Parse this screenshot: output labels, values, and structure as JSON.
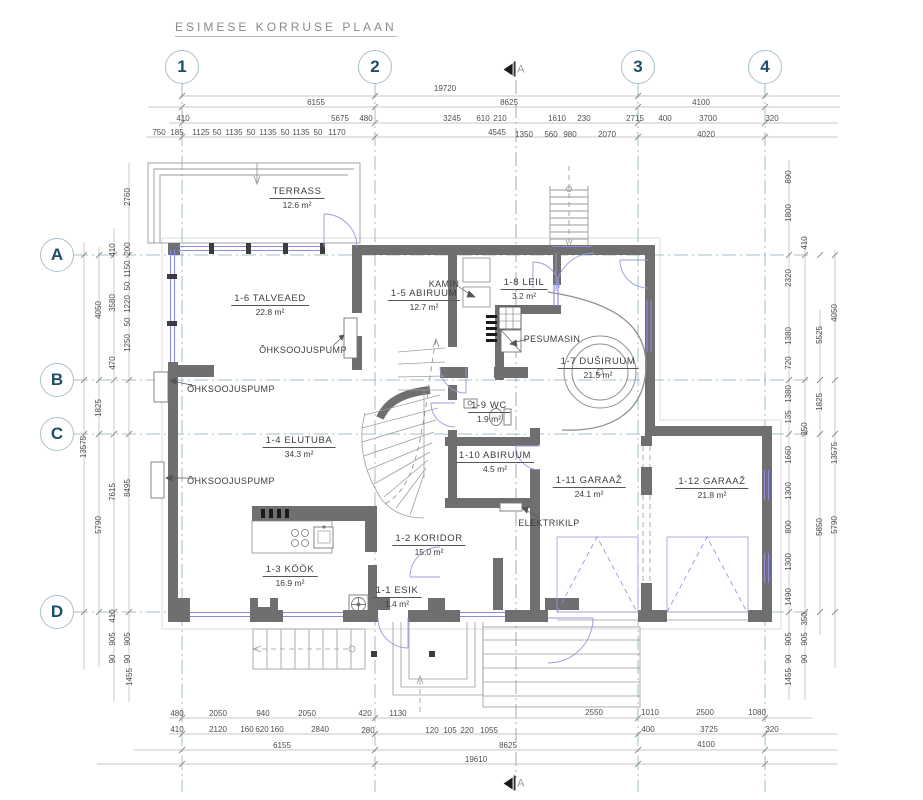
{
  "title": "ESIMESE KORRUSE PLAAN",
  "colors": {
    "wall": "#6f6f6f",
    "window_blue": "#8a8ae0",
    "grid_line": "#86aebe",
    "dim_line": "#b5b5b5",
    "bubble_text": "#1e4f68",
    "detail_line": "#999999"
  },
  "grid": {
    "columns": [
      {
        "label": "1",
        "x": 182,
        "y": 67
      },
      {
        "label": "2",
        "x": 375,
        "y": 67
      },
      {
        "label": "3",
        "x": 638,
        "y": 67
      },
      {
        "label": "4",
        "x": 765,
        "y": 67
      }
    ],
    "rows": [
      {
        "label": "A",
        "x": 57,
        "y": 255
      },
      {
        "label": "B",
        "x": 57,
        "y": 380
      },
      {
        "label": "C",
        "x": 57,
        "y": 434
      },
      {
        "label": "D",
        "x": 57,
        "y": 612
      }
    ]
  },
  "section_markers": [
    {
      "label": "A",
      "x": 514,
      "y": 69
    },
    {
      "label": "A",
      "x": 514,
      "y": 783
    }
  ],
  "rooms": [
    {
      "name": "TERRASS",
      "area": "12.6 m²",
      "x": 297,
      "y": 198
    },
    {
      "name": "1-6 TALVEAED",
      "area": "22.8 m²",
      "x": 270,
      "y": 305
    },
    {
      "name": "1-5 ABIRUUM",
      "area": "12.7 m²",
      "x": 424,
      "y": 300
    },
    {
      "name": "1-8 LEIL",
      "area": "3.2 m²",
      "x": 524,
      "y": 289
    },
    {
      "name": "1-7 DUŠIRUUM",
      "area": "21.5 m²",
      "x": 598,
      "y": 368
    },
    {
      "name": "1-9 WC",
      "area": "1.9 m²",
      "x": 489,
      "y": 412
    },
    {
      "name": "1-4 ELUTUBA",
      "area": "34.3 m²",
      "x": 299,
      "y": 447
    },
    {
      "name": "1-10 ABIRUUM",
      "area": "4.5 m²",
      "x": 495,
      "y": 462
    },
    {
      "name": "1-11 GARAAŽ",
      "area": "24.1 m²",
      "x": 589,
      "y": 487
    },
    {
      "name": "1-12 GARAAŽ",
      "area": "21.8 m²",
      "x": 712,
      "y": 488
    },
    {
      "name": "1-2 KORIDOR",
      "area": "15.0 m²",
      "x": 429,
      "y": 545
    },
    {
      "name": "1-3 KÖÖK",
      "area": "16.9 m²",
      "x": 290,
      "y": 576
    },
    {
      "name": "1-1 ESIK",
      "area": "1.4 m²",
      "x": 397,
      "y": 597
    }
  ],
  "annotations": [
    {
      "t": "ÕHKSOOJUSPUMP",
      "x": 303,
      "y": 350
    },
    {
      "t": "ÕHKSOOJUSPUMP",
      "x": 231,
      "y": 389
    },
    {
      "t": "ÕHKSOOJUSPUMP",
      "x": 231,
      "y": 481
    },
    {
      "t": "KAMIN",
      "x": 444,
      "y": 284
    },
    {
      "t": "PESUMASIN",
      "x": 552,
      "y": 339
    },
    {
      "t": "ELEKTRIKILP",
      "x": 549,
      "y": 523
    }
  ],
  "dim_labels": [
    [
      "19720",
      445,
      89,
      0
    ],
    [
      "6155",
      316,
      103,
      0
    ],
    [
      "8625",
      509,
      103,
      0
    ],
    [
      "4100",
      701,
      103,
      0
    ],
    [
      "410",
      183,
      119,
      0
    ],
    [
      "5675",
      340,
      119,
      0
    ],
    [
      "480",
      366,
      119,
      0
    ],
    [
      "3245",
      452,
      119,
      0
    ],
    [
      "610",
      483,
      119,
      0
    ],
    [
      "210",
      500,
      119,
      0
    ],
    [
      "1610",
      557,
      119,
      0
    ],
    [
      "230",
      584,
      119,
      0
    ],
    [
      "2715",
      635,
      119,
      0
    ],
    [
      "400",
      665,
      119,
      0
    ],
    [
      "3700",
      708,
      119,
      0
    ],
    [
      "320",
      772,
      119,
      0
    ],
    [
      "750",
      159,
      133,
      0
    ],
    [
      "185",
      177,
      133,
      0
    ],
    [
      "1125",
      201,
      133,
      0
    ],
    [
      "50",
      217,
      133,
      0
    ],
    [
      "1135",
      234,
      133,
      0
    ],
    [
      "50",
      251,
      133,
      0
    ],
    [
      "1135",
      268,
      133,
      0
    ],
    [
      "50",
      285,
      133,
      0
    ],
    [
      "1135",
      301,
      133,
      0
    ],
    [
      "50",
      318,
      133,
      0
    ],
    [
      "1170",
      337,
      133,
      0
    ],
    [
      "4545",
      497,
      133,
      0
    ],
    [
      "1350",
      524,
      135,
      0
    ],
    [
      "560",
      551,
      135,
      0
    ],
    [
      "980",
      570,
      135,
      0
    ],
    [
      "2070",
      607,
      135,
      0
    ],
    [
      "4020",
      706,
      135,
      0
    ],
    [
      "480",
      177,
      714,
      0
    ],
    [
      "2050",
      218,
      714,
      0
    ],
    [
      "940",
      263,
      714,
      0
    ],
    [
      "2050",
      307,
      714,
      0
    ],
    [
      "420",
      365,
      714,
      0
    ],
    [
      "1130",
      398,
      714,
      0
    ],
    [
      "2550",
      594,
      713,
      0
    ],
    [
      "1010",
      650,
      713,
      0
    ],
    [
      "2500",
      705,
      713,
      0
    ],
    [
      "1080",
      757,
      713,
      0
    ],
    [
      "410",
      177,
      730,
      0
    ],
    [
      "2120",
      218,
      730,
      0
    ],
    [
      "160",
      247,
      730,
      0
    ],
    [
      "620",
      262,
      730,
      0
    ],
    [
      "160",
      277,
      730,
      0
    ],
    [
      "2840",
      320,
      730,
      0
    ],
    [
      "280",
      368,
      731,
      0
    ],
    [
      "120",
      432,
      731,
      0
    ],
    [
      "105",
      450,
      731,
      0
    ],
    [
      "220",
      467,
      731,
      0
    ],
    [
      "1055",
      489,
      731,
      0
    ],
    [
      "400",
      648,
      730,
      0
    ],
    [
      "3725",
      709,
      730,
      0
    ],
    [
      "320",
      772,
      730,
      0
    ],
    [
      "6155",
      282,
      746,
      0
    ],
    [
      "8625",
      508,
      746,
      0
    ],
    [
      "4100",
      706,
      745,
      0
    ],
    [
      "19610",
      476,
      760,
      0
    ],
    [
      "13575",
      84,
      447,
      1
    ],
    [
      "4050",
      99,
      310,
      1
    ],
    [
      "1825",
      99,
      408,
      1
    ],
    [
      "5790",
      99,
      525,
      1
    ],
    [
      "410",
      113,
      250,
      1
    ],
    [
      "3580",
      113,
      303,
      1
    ],
    [
      "470",
      113,
      363,
      1
    ],
    [
      "7615",
      113,
      492,
      1
    ],
    [
      "410",
      113,
      616,
      1
    ],
    [
      "905",
      113,
      639,
      1
    ],
    [
      "90",
      113,
      659,
      1
    ],
    [
      "2760",
      128,
      197,
      1
    ],
    [
      "200",
      128,
      249,
      1
    ],
    [
      "1150",
      128,
      269,
      1
    ],
    [
      "50",
      128,
      286,
      1
    ],
    [
      "1220",
      128,
      304,
      1
    ],
    [
      "50",
      128,
      322,
      1
    ],
    [
      "1250",
      128,
      343,
      1
    ],
    [
      "8495",
      128,
      488,
      1
    ],
    [
      "905",
      128,
      639,
      1
    ],
    [
      "90",
      128,
      659,
      1
    ],
    [
      "1455",
      130,
      677,
      1
    ],
    [
      "890",
      789,
      177,
      1
    ],
    [
      "1800",
      789,
      213,
      1
    ],
    [
      "2320",
      789,
      278,
      1
    ],
    [
      "1380",
      789,
      336,
      1
    ],
    [
      "720",
      789,
      363,
      1
    ],
    [
      "1380",
      789,
      394,
      1
    ],
    [
      "135",
      789,
      417,
      1
    ],
    [
      "1660",
      789,
      455,
      1
    ],
    [
      "1300",
      789,
      491,
      1
    ],
    [
      "800",
      789,
      527,
      1
    ],
    [
      "1300",
      789,
      562,
      1
    ],
    [
      "1490",
      789,
      597,
      1
    ],
    [
      "905",
      789,
      639,
      1
    ],
    [
      "90",
      789,
      659,
      1
    ],
    [
      "1455",
      789,
      677,
      1
    ],
    [
      "410",
      805,
      243,
      1
    ],
    [
      "350",
      805,
      429,
      1
    ],
    [
      "350",
      805,
      619,
      1
    ],
    [
      "905",
      805,
      639,
      1
    ],
    [
      "90",
      805,
      659,
      1
    ],
    [
      "5525",
      820,
      335,
      1
    ],
    [
      "1825",
      820,
      402,
      1
    ],
    [
      "5850",
      820,
      527,
      1
    ],
    [
      "4050",
      835,
      313,
      1
    ],
    [
      "13575",
      835,
      453,
      1
    ],
    [
      "5790",
      835,
      525,
      1
    ]
  ]
}
